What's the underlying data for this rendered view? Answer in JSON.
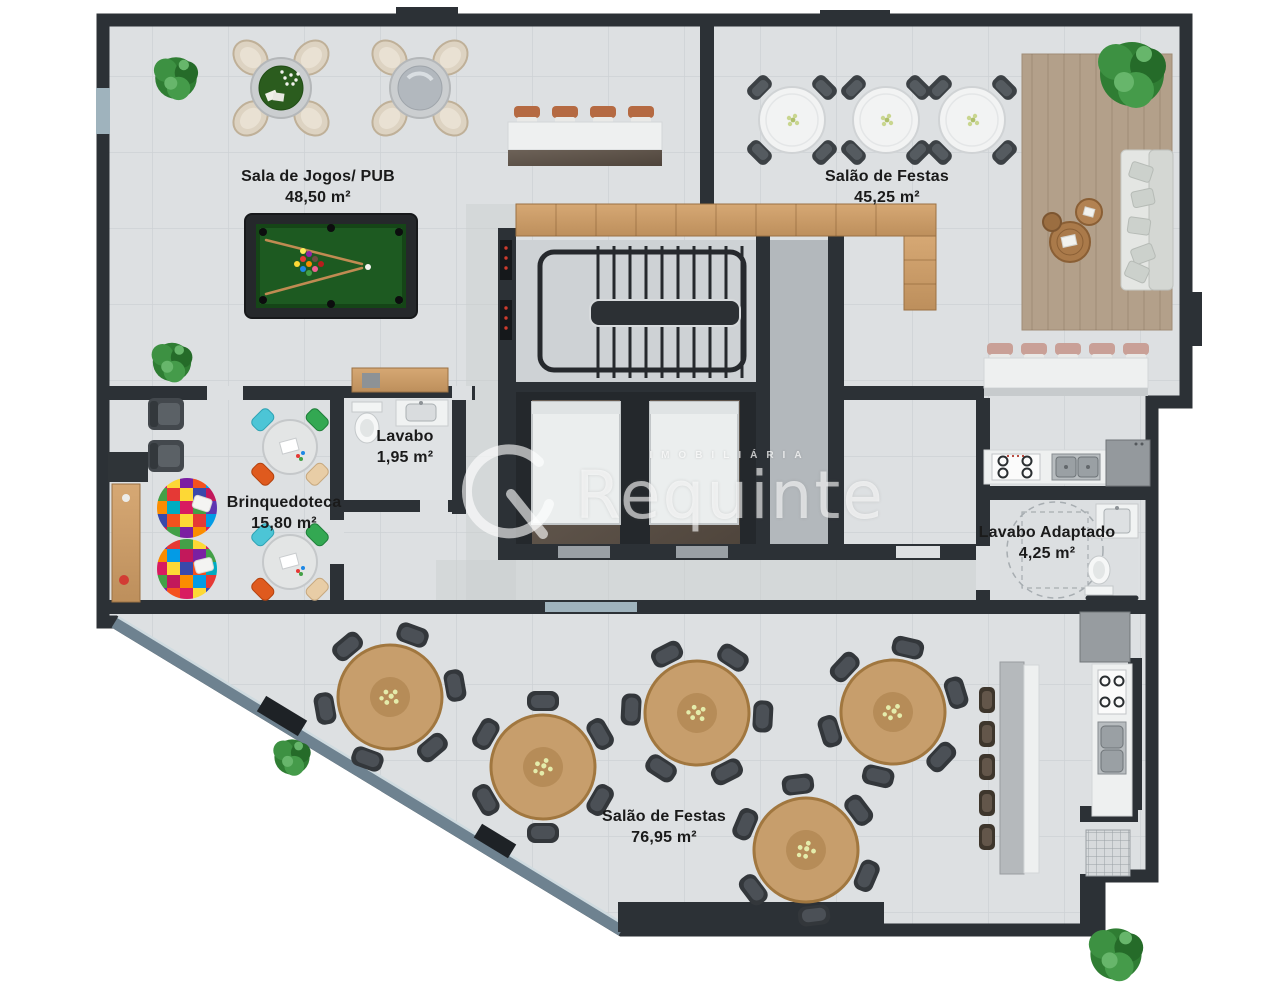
{
  "watermark": {
    "brand": "Requinte",
    "tagline": "IMOBILIÁRIA"
  },
  "rooms": [
    {
      "id": "sala-de-jogos",
      "name": "Sala de Jogos/ PUB",
      "area": "48,50 m²"
    },
    {
      "id": "salao-festas-1",
      "name": "Salão de Festas",
      "area": "45,25 m²"
    },
    {
      "id": "lavabo",
      "name": "Lavabo",
      "area": "1,95 m²"
    },
    {
      "id": "brinquedoteca",
      "name": "Brinquedoteca",
      "area": "15,80 m²"
    },
    {
      "id": "lavabo-adaptado",
      "name": "Lavabo Adaptado",
      "area": "4,25 m²"
    },
    {
      "id": "salao-festas-2",
      "name": "Salão de Festas",
      "area": "76,95 m²"
    }
  ],
  "palette": {
    "wall": "#2c3136",
    "floor": "#dde0e2",
    "wood": "#c79e6c",
    "pool_felt": "#1d5a21",
    "plant_green": "#2f7d33",
    "glass": "#6e8290",
    "watermark": "#ffffff"
  }
}
